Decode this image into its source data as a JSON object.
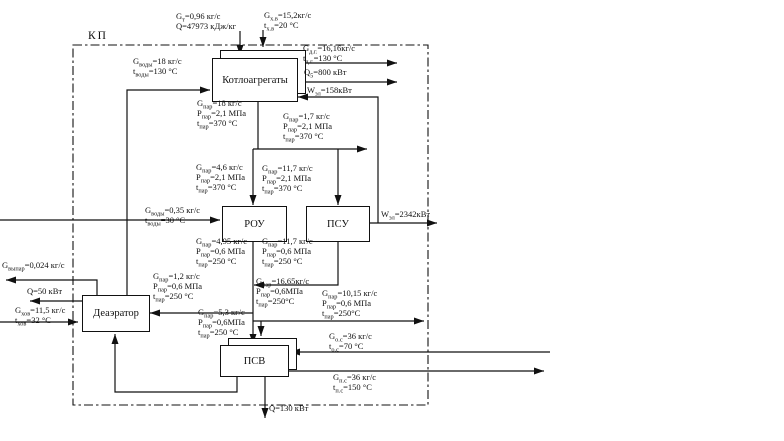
{
  "diagram": {
    "boundary_label": "КП",
    "blocks": {
      "boilers": {
        "label": "Котлоагрегаты"
      },
      "rou": {
        "label": "РОУ"
      },
      "psu": {
        "label": "ПСУ"
      },
      "deaerator": {
        "label": "Деаэратор"
      },
      "psv": {
        "label": "ПСВ"
      }
    },
    "streams": {
      "fuel": {
        "lines": [
          {
            "s": "G",
            "b": "т",
            "v": "=0,96 кг/с"
          },
          {
            "s": "Q",
            "b": "",
            "v": "=47973 кДж/кг"
          }
        ]
      },
      "cold_air": {
        "lines": [
          {
            "s": "G",
            "b": "х.в",
            "v": "=15,2кг/с"
          },
          {
            "s": "t",
            "b": "х.в",
            "v": "=20 °С"
          }
        ]
      },
      "feedwater": {
        "lines": [
          {
            "s": "G",
            "b": "воды",
            "v": "=18 кг/с"
          },
          {
            "s": "t",
            "b": "воды",
            "v": "=130 °С"
          }
        ]
      },
      "flue_gas": {
        "lines": [
          {
            "s": "G",
            "b": "д.г.",
            "v": "=16,16кг/с"
          },
          {
            "s": "t",
            "b": "д.г.",
            "v": "=130 °С"
          }
        ]
      },
      "q_boiler": {
        "lines": [
          {
            "s": "Q",
            "b": "5",
            "v": "=800 кВт"
          }
        ]
      },
      "w_boiler": {
        "lines": [
          {
            "s": "W",
            "b": "эл",
            "v": "=158кВт"
          }
        ]
      },
      "steam_main": {
        "lines": [
          {
            "s": "G",
            "b": "пар",
            "v": "=18 кг/с"
          },
          {
            "s": "P",
            "b": "пар",
            "v": "=2,1 МПа"
          },
          {
            "s": "t",
            "b": "пар",
            "v": "=370 °С"
          }
        ]
      },
      "steam_export": {
        "lines": [
          {
            "s": "G",
            "b": "пар",
            "v": "=1,7 кг/с"
          },
          {
            "s": "P",
            "b": "пар",
            "v": "=2,1 МПа"
          },
          {
            "s": "t",
            "b": "пар",
            "v": "=370 °С"
          }
        ]
      },
      "rou_in": {
        "lines": [
          {
            "s": "G",
            "b": "пар",
            "v": "=4,6 кг/с"
          },
          {
            "s": "P",
            "b": "пар",
            "v": "=2,1 МПа"
          },
          {
            "s": "t",
            "b": "пар",
            "v": "=370 °С"
          }
        ]
      },
      "psu_in": {
        "lines": [
          {
            "s": "G",
            "b": "пар",
            "v": "=11,7 кг/с"
          },
          {
            "s": "P",
            "b": "пар",
            "v": "=2,1 МПа"
          },
          {
            "s": "t",
            "b": "пар",
            "v": "=370 °С"
          }
        ]
      },
      "injection": {
        "lines": [
          {
            "s": "G",
            "b": "воды",
            "v": "=0,35 кг/с"
          },
          {
            "s": "t",
            "b": "воды",
            "v": "=30 °С"
          }
        ]
      },
      "w_out": {
        "lines": [
          {
            "s": "W",
            "b": "эл",
            "v": "=2342кВт"
          }
        ]
      },
      "rou_out": {
        "lines": [
          {
            "s": "G",
            "b": "пар",
            "v": "=4,95 кг/с"
          },
          {
            "s": "P",
            "b": "пар",
            "v": "=0,6 МПа"
          },
          {
            "s": "t",
            "b": "пар",
            "v": "=250 °С"
          }
        ]
      },
      "psu_out": {
        "lines": [
          {
            "s": "G",
            "b": "пар",
            "v": "=11,7 кг/с"
          },
          {
            "s": "P",
            "b": "пар",
            "v": "=0,6 МПа"
          },
          {
            "s": "t",
            "b": "пар",
            "v": "=250 °С"
          }
        ]
      },
      "header_06": {
        "lines": [
          {
            "s": "G",
            "b": "пар",
            "v": "=16,65кг/с"
          },
          {
            "s": "P",
            "b": "пар",
            "v": "=0,6МПа"
          },
          {
            "s": "t",
            "b": "пар",
            "v": "=250°С"
          }
        ]
      },
      "deaer_steam": {
        "lines": [
          {
            "s": "G",
            "b": "пар",
            "v": "=1,2 кг/с"
          },
          {
            "s": "P",
            "b": "пар",
            "v": "=0,6 МПа"
          },
          {
            "s": "t",
            "b": "пар",
            "v": "=250 °С"
          }
        ]
      },
      "psv_steam": {
        "lines": [
          {
            "s": "G",
            "b": "пар",
            "v": "=5,3 кг/с"
          },
          {
            "s": "P",
            "b": "пар",
            "v": "=0,6МПа"
          },
          {
            "s": "t",
            "b": "пар",
            "v": "=250 °С"
          }
        ]
      },
      "steam_cons": {
        "lines": [
          {
            "s": "G",
            "b": "пар",
            "v": "=10,15 кг/с"
          },
          {
            "s": "P",
            "b": "пар",
            "v": "=0,6 МПа"
          },
          {
            "s": "t",
            "b": "пар",
            "v": "=250°С"
          }
        ]
      },
      "vypar": {
        "lines": [
          {
            "s": "G",
            "b": "выпар",
            "v": "=0,024 кг/с"
          }
        ]
      },
      "q_deaer": {
        "lines": [
          {
            "s": "Q",
            "b": "",
            "v": "=50 кВт"
          }
        ]
      },
      "hov_water": {
        "lines": [
          {
            "s": "G",
            "b": "хов",
            "v": "=11,5 кг/с"
          },
          {
            "s": "t",
            "b": "хов",
            "v": "=32 °С"
          }
        ]
      },
      "net_return": {
        "lines": [
          {
            "s": "G",
            "b": "о.с",
            "v": "=36 кг/с"
          },
          {
            "s": "t",
            "b": "о.с",
            "v": "=70 °С"
          }
        ]
      },
      "net_supply": {
        "lines": [
          {
            "s": "G",
            "b": "п.с",
            "v": "=36 кг/с"
          },
          {
            "s": "t",
            "b": "п.с",
            "v": "=150 °С"
          }
        ]
      },
      "q_psv": {
        "lines": [
          {
            "s": "Q",
            "b": "",
            "v": "=130 кВт"
          }
        ]
      }
    }
  }
}
